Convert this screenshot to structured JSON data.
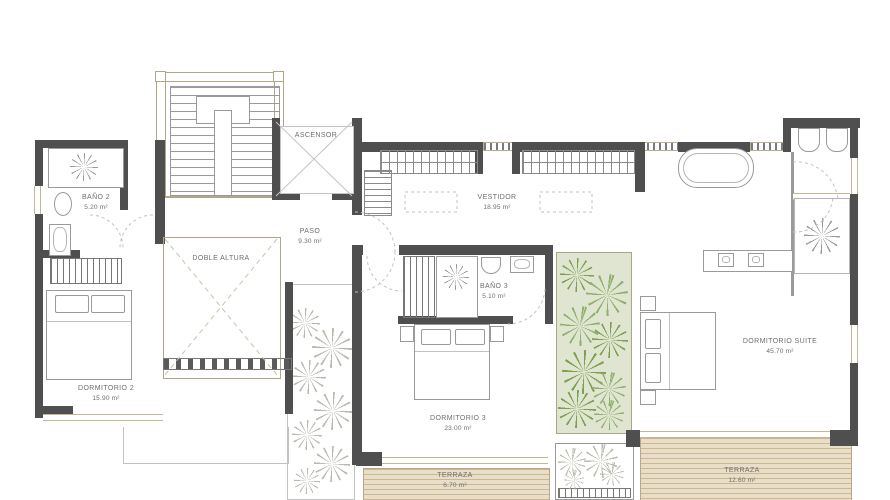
{
  "plan": {
    "type": "floor-plan",
    "rooms": {
      "ascensor": {
        "label": "ASCENSOR"
      },
      "bano2": {
        "label": "BAÑO 2",
        "area": "5.20 m²"
      },
      "paso": {
        "label": "PASO",
        "area": "9.30 m²"
      },
      "doble_altura": {
        "label": "DOBLE ALTURA"
      },
      "vestidor": {
        "label": "VESTIDOR",
        "area": "18.95 m²"
      },
      "bano3": {
        "label": "BAÑO 3",
        "area": "5.10 m²"
      },
      "dormitorio2": {
        "label": "DORMITORIO 2",
        "area": "15.90 m²"
      },
      "dormitorio3": {
        "label": "DORMITORIO 3",
        "area": "23.00 m²"
      },
      "suite": {
        "label": "DORMITORIO SUITE",
        "area": "45.70 m²"
      },
      "terraza_izq": {
        "label": "TERRAZA",
        "area": "6.70 m²"
      },
      "terraza_der": {
        "label": "TERRAZA",
        "area": "12.60 m²"
      }
    },
    "colors": {
      "wall": "#4f4f4f",
      "deck_wood": "#e9dfc9",
      "deck_stripe": "#c9b795",
      "patio_green_bg": "#dfe5d0",
      "plant_green": "#7aa150",
      "plant_sketch_gray": "#aab0a0",
      "window_frame": "#c3b893",
      "label_text": "#6e6e6e"
    }
  }
}
